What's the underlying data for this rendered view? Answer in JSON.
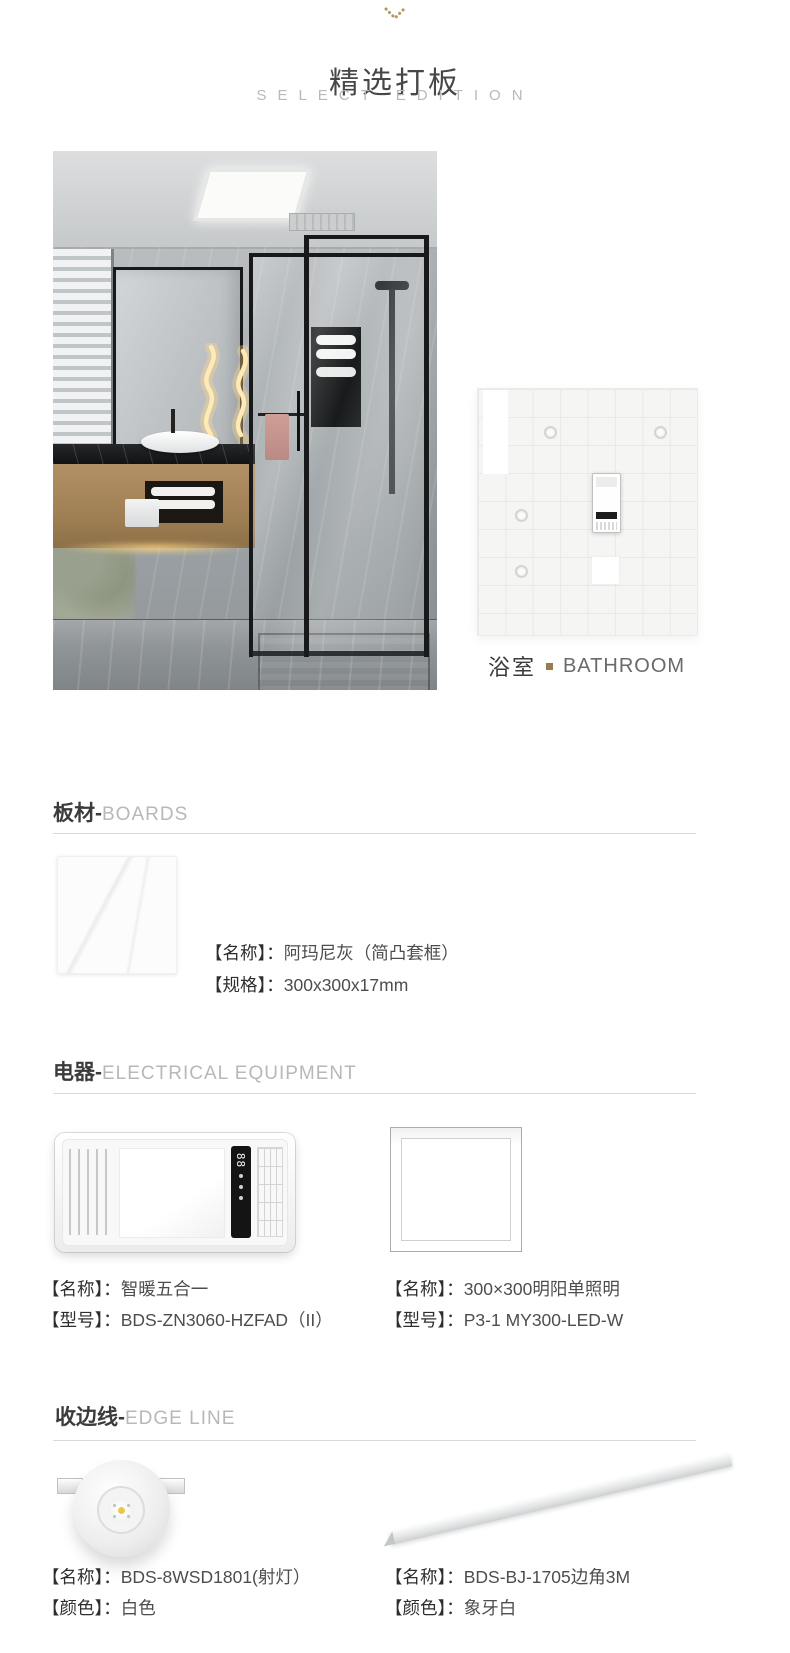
{
  "header": {
    "title": "精选打板",
    "subtitle": "SELECT EDITION"
  },
  "hero": {
    "room_zh": "浴室",
    "room_en": "BATHROOM"
  },
  "sections": {
    "boards": {
      "zh": "板材-",
      "en": "BOARDS"
    },
    "electrical": {
      "zh": "电器-",
      "en": "ELECTRICAL EQUIPMENT"
    },
    "edge": {
      "zh": "收边线-",
      "en": "EDGE LINE"
    }
  },
  "products": {
    "board": {
      "name_label": "【名称】：",
      "name": "阿玛尼灰（简凸套框）",
      "spec_label": "【规格】：",
      "spec": "300x300x17mm"
    },
    "heater": {
      "name_label": "【名称】：",
      "name": "智暖五合一",
      "model_label": "【型号】：",
      "model": "BDS-ZN3060-HZFAD（II）",
      "panel_display": "88"
    },
    "led_panel": {
      "name_label": "【名称】：",
      "name": "300×300明阳单照明",
      "model_label": "【型号】：",
      "model": "P3-1 MY300-LED-W"
    },
    "spotlight": {
      "name_label": "【名称】：",
      "name": "BDS-8WSD1801(射灯）",
      "color_label": "【颜色】：",
      "color": "白色"
    },
    "edge_strip": {
      "name_label": "【名称】：",
      "name": "BDS-BJ-1705边角3M",
      "color_label": "【颜色】：",
      "color": "象牙白"
    }
  },
  "colors": {
    "accent_gold": "#9c7c4c",
    "text_dark": "#3b3b3b",
    "text_light": "#b8b8b8",
    "rule": "#d9d9d9"
  }
}
